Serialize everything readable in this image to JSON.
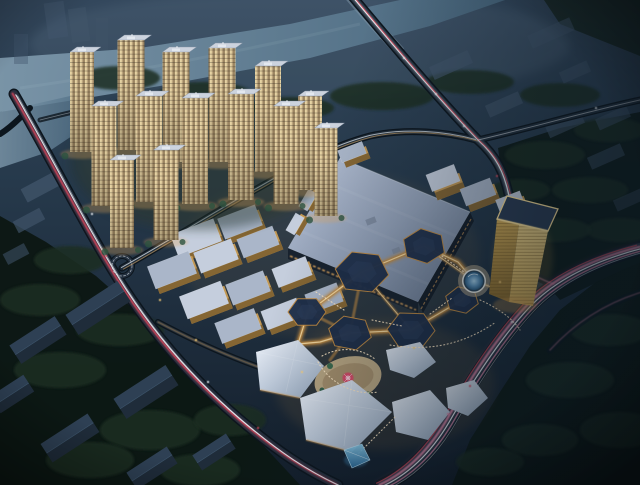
{
  "scene": {
    "type": "aerial-architectural-rendering",
    "time_of_day": "night",
    "elements": [
      "river",
      "highway-bridge",
      "residential-tower-cluster",
      "retail-street-blocks",
      "shopping-mall-bigbox",
      "hexagonal-pavilion-plaza",
      "circular-fountain",
      "gold-office-tower",
      "faceted-event-pavilions",
      "carousel",
      "glass-pyramid",
      "tree-parkland",
      "light-trail-roads",
      "roundabout"
    ]
  },
  "palette": {
    "sky_top": "#33475c",
    "sky_mid": "#26394b",
    "sky_low": "#141f2c",
    "shade_right": "#0b1722",
    "river_light": "#7d98ab",
    "river_dark": "#49687f",
    "haze": "#9db4c6",
    "tree_dark": "#0c1814",
    "tree_mid": "#15241d",
    "tree_blob": "#1b2d23",
    "road_casing": "#0c151d",
    "road_surface": "#243140",
    "trail_white": "#eef3f8",
    "trail_red": "#e04a5e",
    "trail_pink": "#e087a8",
    "trail_gold": "#e8b26a",
    "ghost": "#42566b",
    "warehouse_top": "#2e4054",
    "warehouse_side": "#1f2c3a",
    "tower_face_light": "#e6d3a4",
    "tower_face": "#bca57e",
    "tower_face_shade": "#85704f",
    "tower_roof": "#ccd3de",
    "tower_glow": "#e3a75c",
    "retail_roof_a": "#c5cedd",
    "retail_roof_b": "#aab6c9",
    "retail_facade": "#c89c55",
    "retail_facade_dark": "#7e6130",
    "mall_roof_light": "#b3bed2",
    "mall_roof": "#93a1b8",
    "mall_edge": "#6e7d95",
    "mall_shop_glow": "#dda45c",
    "hex_roof": "#1f2f4a",
    "hex_roof_light": "#2b3d5c",
    "walkway": "#c08a42",
    "walkway_core": "#f6d9a0",
    "fountain_plaza": "#c2b092",
    "fountain_rim": "#e8e8e2",
    "fountain_ring": "#2b4458",
    "fountain_water": "#5e93bb",
    "gold_light": "#f2d488",
    "gold_mid": "#d4ac56",
    "gold_dark": "#8f6d2c",
    "gold_roof": "#2c3c54",
    "gold_rim": "#ffe29a",
    "facet_light": "#e9eef6",
    "facet_mid": "#c3cfdf",
    "facet_shade": "#9fb0c5",
    "plaza_warm": "#c9b28b",
    "plaza_shade": "#a08a66",
    "crowd": "#ffe9c6",
    "carousel_red": "#d84a68",
    "carousel_pink": "#f0a8bc",
    "pyramid_light": "#8ed0ee",
    "pyramid_dark": "#2e6e9e",
    "glow_warm": "#d89c4e"
  },
  "terrain": {
    "tree_blobs": [
      [
        120,
        78,
        40,
        12
      ],
      [
        205,
        95,
        48,
        13
      ],
      [
        292,
        108,
        42,
        11
      ],
      [
        382,
        96,
        52,
        14
      ],
      [
        470,
        82,
        44,
        12
      ],
      [
        560,
        95,
        40,
        12
      ],
      [
        610,
        130,
        36,
        12
      ],
      [
        545,
        155,
        40,
        14
      ],
      [
        590,
        190,
        38,
        13
      ],
      [
        620,
        230,
        34,
        12
      ],
      [
        555,
        230,
        36,
        12
      ],
      [
        520,
        190,
        30,
        11
      ],
      [
        70,
        260,
        36,
        14
      ],
      [
        40,
        300,
        40,
        16
      ],
      [
        120,
        330,
        44,
        16
      ],
      [
        60,
        370,
        46,
        18
      ],
      [
        150,
        430,
        50,
        20
      ],
      [
        90,
        460,
        44,
        18
      ],
      [
        230,
        420,
        36,
        16
      ],
      [
        200,
        470,
        40,
        16
      ],
      [
        610,
        330,
        40,
        16
      ],
      [
        570,
        380,
        44,
        18
      ],
      [
        620,
        430,
        40,
        18
      ],
      [
        540,
        440,
        38,
        16
      ],
      [
        490,
        462,
        34,
        14
      ]
    ]
  },
  "roads": {
    "vehicles": [
      [
        404,
        58,
        "w"
      ],
      [
        436,
        94,
        "w"
      ],
      [
        464,
        126,
        "w"
      ],
      [
        497,
        176,
        "r"
      ],
      [
        536,
        296,
        "p"
      ],
      [
        512,
        322,
        "w"
      ],
      [
        470,
        386,
        "r"
      ],
      [
        448,
        414,
        "p"
      ],
      [
        92,
        214,
        "w"
      ],
      [
        106,
        256,
        "r"
      ],
      [
        208,
        382,
        "w"
      ],
      [
        258,
        428,
        "r"
      ],
      [
        596,
        108,
        "w"
      ],
      [
        160,
        300,
        "g"
      ],
      [
        196,
        340,
        "g"
      ],
      [
        302,
        372,
        "g"
      ],
      [
        414,
        348,
        "g"
      ],
      [
        500,
        282,
        "g"
      ]
    ]
  },
  "buildings": {
    "residential_towers": [
      [
        82,
        52,
        24,
        100
      ],
      [
        131,
        40,
        27,
        110
      ],
      [
        176,
        52,
        27,
        110
      ],
      [
        222,
        48,
        27,
        114
      ],
      [
        268,
        66,
        26,
        106
      ],
      [
        310,
        96,
        24,
        94
      ],
      [
        104,
        106,
        25,
        100
      ],
      [
        149,
        96,
        26,
        106
      ],
      [
        195,
        98,
        26,
        106
      ],
      [
        241,
        94,
        26,
        106
      ],
      [
        286,
        106,
        25,
        98
      ],
      [
        326,
        128,
        23,
        88
      ],
      [
        122,
        160,
        24,
        88
      ],
      [
        166,
        150,
        25,
        90
      ]
    ],
    "retail_blocks": [
      [
        196,
        238,
        46,
        24,
        -21,
        "a"
      ],
      [
        240,
        222,
        40,
        22,
        -21,
        "b"
      ],
      [
        172,
        270,
        44,
        24,
        -21,
        "b"
      ],
      [
        216,
        256,
        40,
        22,
        -21,
        "a"
      ],
      [
        258,
        242,
        38,
        20,
        -21,
        "b"
      ],
      [
        204,
        300,
        44,
        24,
        -21,
        "a"
      ],
      [
        248,
        288,
        40,
        22,
        -21,
        "b"
      ],
      [
        292,
        272,
        36,
        20,
        -21,
        "a"
      ],
      [
        238,
        326,
        42,
        22,
        -21,
        "b"
      ],
      [
        282,
        314,
        38,
        20,
        -21,
        "a"
      ],
      [
        324,
        298,
        34,
        20,
        -21,
        "b"
      ]
    ],
    "east_blocks": [
      [
        443,
        178,
        30,
        18,
        -21,
        "a",
        10
      ],
      [
        478,
        192,
        32,
        18,
        -21,
        "b",
        7
      ],
      [
        510,
        202,
        26,
        14,
        -21,
        "a",
        6
      ],
      [
        352,
        152,
        26,
        13,
        -21,
        "b",
        6
      ],
      [
        322,
        176,
        20,
        10,
        -60,
        "a",
        5
      ],
      [
        308,
        200,
        20,
        10,
        -60,
        "b",
        5
      ],
      [
        295,
        224,
        20,
        10,
        -60,
        "a",
        5
      ]
    ],
    "hex_pavilions": [
      [
        362,
        272,
        27,
        8
      ],
      [
        424,
        246,
        22,
        22
      ],
      [
        307,
        312,
        19,
        0
      ],
      [
        350,
        333,
        22,
        14
      ],
      [
        411,
        330,
        24,
        2
      ],
      [
        462,
        300,
        17,
        16
      ]
    ],
    "warehouses": [
      [
        98,
        308,
        62,
        24
      ],
      [
        38,
        340,
        54,
        22
      ],
      [
        146,
        392,
        62,
        24
      ],
      [
        70,
        438,
        56,
        22
      ],
      [
        12,
        394,
        40,
        20
      ],
      [
        152,
        468,
        48,
        20
      ],
      [
        214,
        452,
        40,
        18
      ]
    ],
    "ghost_slabs": [
      [
        46,
        2,
        20,
        36,
        -8,
        0.5
      ],
      [
        70,
        8,
        18,
        34,
        -8,
        0.45
      ],
      [
        14,
        34,
        14,
        30,
        0,
        0.4
      ],
      [
        96,
        18,
        12,
        32,
        0,
        0.3
      ],
      [
        430,
        58,
        42,
        14,
        -24,
        0.65
      ],
      [
        528,
        26,
        46,
        14,
        -24,
        0.55
      ],
      [
        560,
        66,
        30,
        12,
        -24,
        0.5
      ],
      [
        486,
        98,
        36,
        13,
        -24,
        0.65
      ],
      [
        546,
        118,
        38,
        13,
        -24,
        0.6
      ],
      [
        596,
        112,
        34,
        12,
        -24,
        0.55
      ],
      [
        588,
        150,
        36,
        13,
        -24,
        0.55
      ],
      [
        614,
        194,
        30,
        12,
        -24,
        0.45
      ],
      [
        22,
        180,
        36,
        15,
        -28,
        0.75
      ],
      [
        14,
        214,
        30,
        13,
        -28,
        0.65
      ],
      [
        4,
        248,
        24,
        12,
        -28,
        0.55
      ]
    ]
  },
  "landmarks": {
    "fountain": {
      "cx": 474,
      "cy": 281,
      "r": 10
    },
    "carousel": {
      "cx": 348,
      "cy": 378,
      "r": 5.5
    },
    "pyramid": {
      "points": "344,450 362,444 370,460 352,468"
    },
    "gold_tower": {
      "roof": "507,196 558,209 548,231 497,219"
    }
  }
}
